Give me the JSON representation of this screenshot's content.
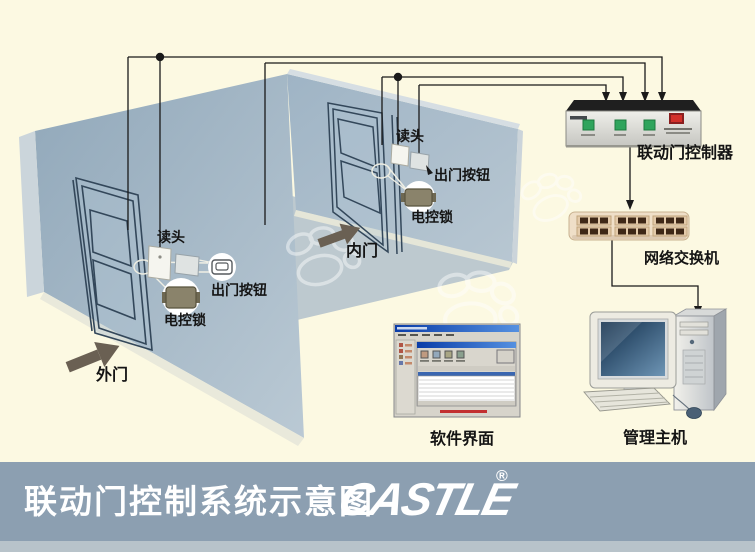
{
  "banner": {
    "title": "联动门控制系统示意图",
    "logo": "CASTLE",
    "registered": "®"
  },
  "room": {
    "outer_door_label": "外门",
    "inner_door_label": "内门"
  },
  "devices": {
    "outer": {
      "reader": "读头",
      "exit_button": "出门按钮",
      "lock": "电控锁"
    },
    "inner": {
      "reader": "读头",
      "exit_button": "出门按钮",
      "lock": "电控锁"
    }
  },
  "equipment": {
    "controller": "联动门控制器",
    "network_switch": "网络交换机",
    "software_ui": "软件界面",
    "management_host": "管理主机"
  },
  "colors": {
    "background": "#FCF9E2",
    "banner": "#8C9FB1",
    "banner_bottom_strip": "#B8C3CA",
    "banner_text": "#FFFFFF",
    "wall_left": "#A3B8C8",
    "wall_right": "#AEC1CE",
    "floor": "#BDC9CF",
    "baseboard": "#E9E9DB",
    "door_outline": "#33475A",
    "direction_arrow": "#6A6053",
    "wire": "#1A1A1A",
    "controller_body": "#DDDDD8",
    "controller_top": "#1F1F1F",
    "controller_button": "#2FA45C",
    "controller_power": "#D2302A",
    "switch_body": "#EFDFC8",
    "switch_port": "#3E2817",
    "lock_body": "#8A836B",
    "screen_blue": "#16324F",
    "software_alert": "#C23030"
  }
}
